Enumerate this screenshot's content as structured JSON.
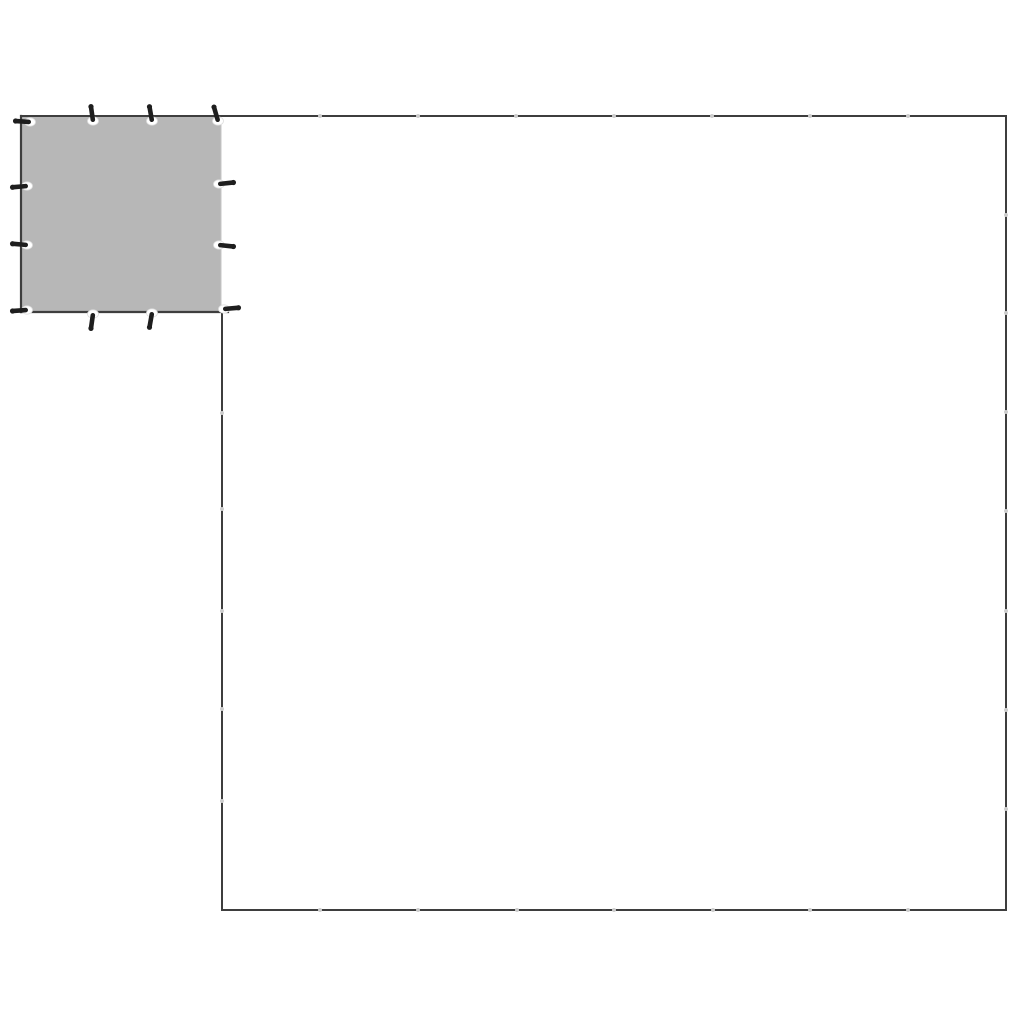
{
  "canvas": {
    "width": 1024,
    "height": 1024,
    "background": "#ffffff"
  },
  "colors": {
    "outline": "#3e3e3e",
    "tarp_fill": "#b7b7b7",
    "tarp_fill_edge": "#c6c6c6",
    "grommet_fill": "#ffffff",
    "grommet_ring": "#dedede",
    "pin": "#1e1e1e",
    "joint_dot": "#cdcdcd"
  },
  "small_tarp": {
    "left": 21,
    "top": 116,
    "right": 221,
    "bottom": 312,
    "stroke_width": 2.2
  },
  "large_tarp_outline": {
    "left": 222,
    "top": 116,
    "right": 1006,
    "bottom": 910,
    "left_edge_start_y": 311,
    "stroke_width": 2,
    "joints": {
      "top_x": [
        320,
        418,
        516,
        614,
        712,
        810,
        908
      ],
      "bottom_x": [
        320,
        418,
        517,
        614,
        713,
        810,
        908
      ],
      "right_y": [
        215,
        313,
        412,
        511,
        611,
        710,
        809
      ],
      "left_y": [
        413,
        509,
        611,
        709,
        801
      ]
    }
  },
  "grommets": [
    {
      "x": 30,
      "y": 122,
      "dir": "left",
      "tilt": 4
    },
    {
      "x": 93,
      "y": 121,
      "dir": "up",
      "tilt": -8
    },
    {
      "x": 152,
      "y": 121,
      "dir": "up",
      "tilt": -10
    },
    {
      "x": 218,
      "y": 121,
      "dir": "up",
      "tilt": -16
    },
    {
      "x": 27,
      "y": 186,
      "dir": "left",
      "tilt": -5
    },
    {
      "x": 27,
      "y": 245,
      "dir": "left",
      "tilt": 5
    },
    {
      "x": 27,
      "y": 310,
      "dir": "left",
      "tilt": -4
    },
    {
      "x": 219,
      "y": 184,
      "dir": "right",
      "tilt": -6
    },
    {
      "x": 219,
      "y": 245,
      "dir": "right",
      "tilt": 6
    },
    {
      "x": 224,
      "y": 309,
      "dir": "right",
      "tilt": -5
    },
    {
      "x": 93,
      "y": 314,
      "dir": "down",
      "tilt": 8
    },
    {
      "x": 152,
      "y": 313,
      "dir": "down",
      "tilt": 10
    }
  ],
  "grommet_geometry": {
    "eyelet_rx": 5.5,
    "eyelet_ry": 4.2,
    "pin_length": 17,
    "pin_width": 4.6,
    "pin_offset": 7.5
  }
}
